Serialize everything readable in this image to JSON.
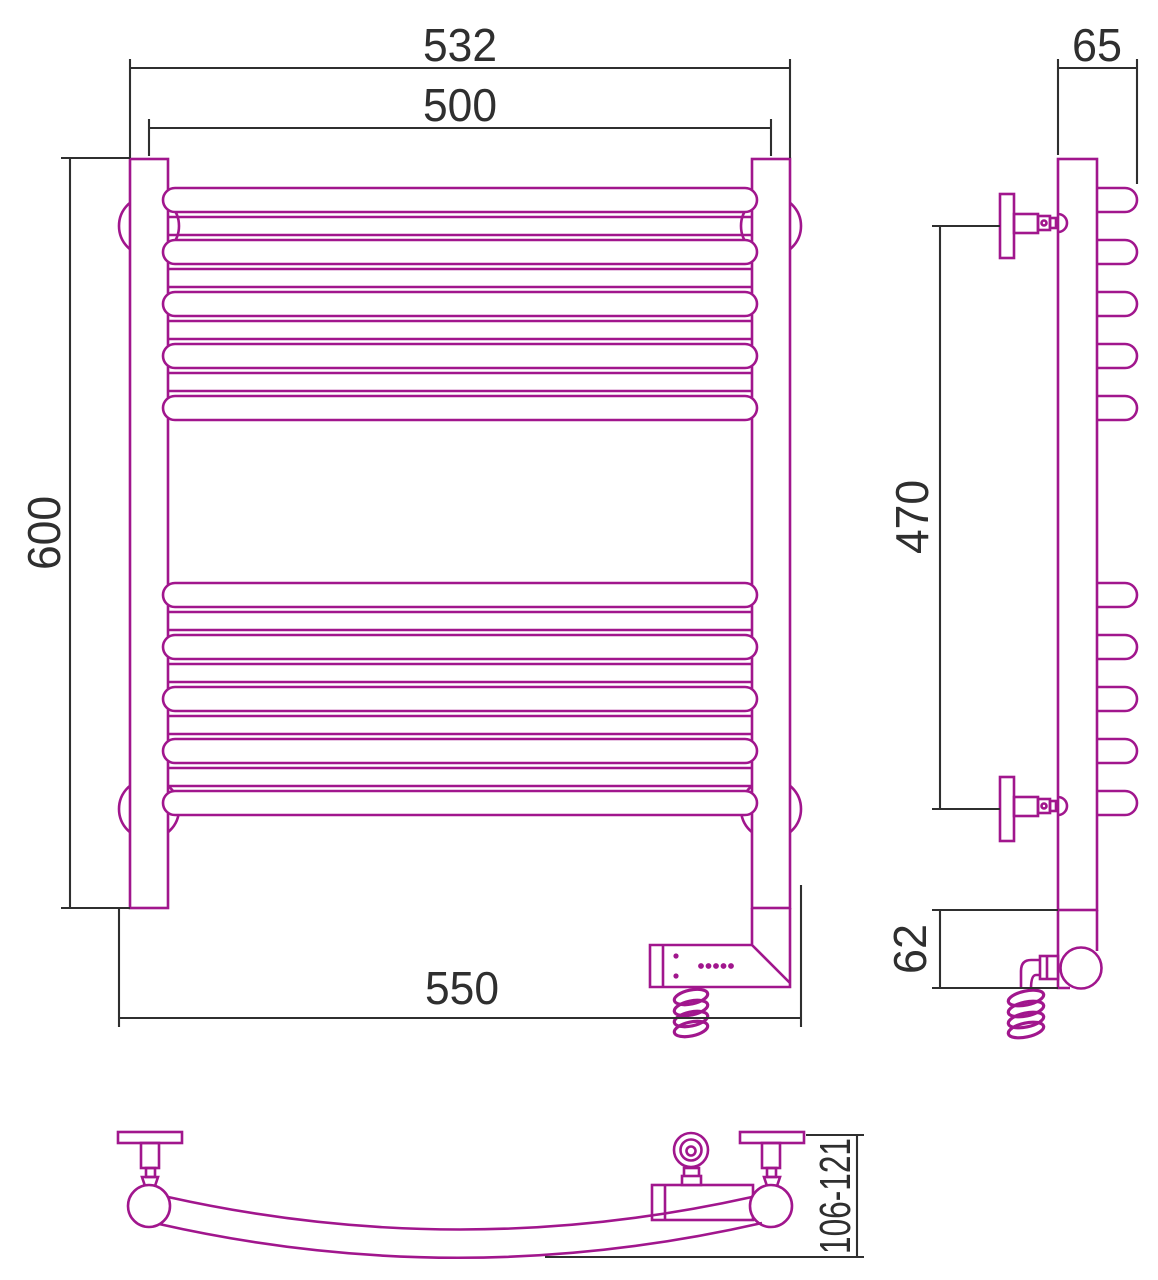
{
  "document": {
    "kind": "technical dimension drawing",
    "subject": "curved electric heated towel rail",
    "views": [
      "front",
      "side",
      "top"
    ]
  },
  "colors": {
    "outline": "#A1168D",
    "dimension": "#2F2F2F",
    "background": "#FFFFFF"
  },
  "front": {
    "rung_groups": 2,
    "rungs_per_group": 5,
    "dims": {
      "outer_width": "532",
      "center_width": "500",
      "height": "600",
      "bottom_width": "550"
    }
  },
  "side": {
    "dims": {
      "depth": "65",
      "bracket_span": "470",
      "unit_height": "62"
    }
  },
  "top": {
    "dims": {
      "wall_offset_range": "106-121"
    }
  }
}
